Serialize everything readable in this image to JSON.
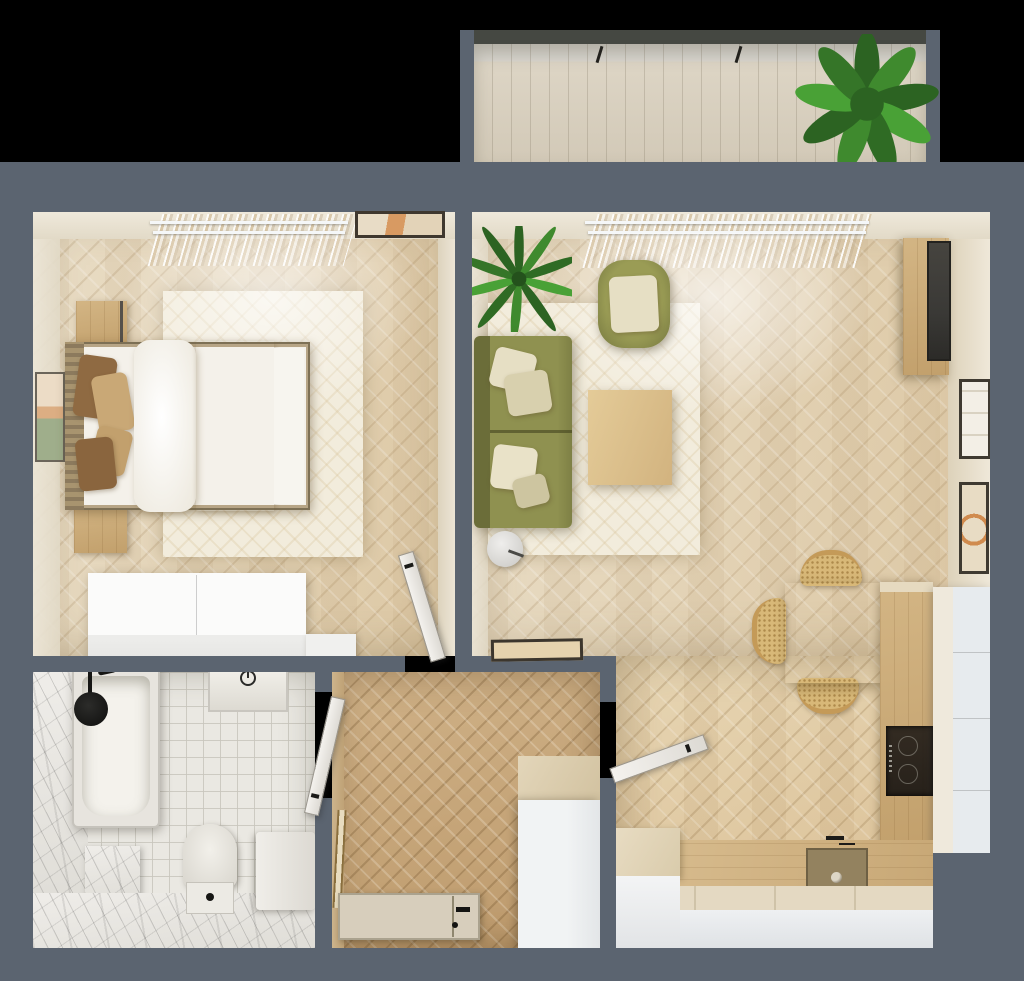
{
  "meta": {
    "title": "apartment-floor-plan-top-view",
    "type": "photorealistic 3D top-down render of a one-bedroom apartment",
    "visible_text": "none"
  },
  "palette": {
    "background": "#000000",
    "wall": "#5b6470",
    "balcony_top_wall": "#454842",
    "deck": "#ddd5c5",
    "floor_light": "#e9ddc6",
    "floor_mid": "#dcc7a3",
    "floor_hall": "#cfb187",
    "rug": "#f2ecdc",
    "tile": "#eae8e2",
    "marble": "#efede9",
    "wood": "#d6ba8c",
    "wood_table": "#eedfb2",
    "cane": "#d8b878",
    "sofa": "#8f9150",
    "sofa_shadow": "#6b6d39",
    "cushion": "#e6dfc4",
    "pillow_tan": "#c9a876",
    "pillow_brown": "#8f6a42",
    "duvet": "#f8f6f1",
    "throw": "#cdab7c",
    "white_furniture": "#f2f3f4",
    "cabinet_front": "#e7ebee",
    "tv": "#3a3936",
    "hob": "#27211a",
    "sink": "#93825f",
    "entry_door": "#d7cebc",
    "plant_green": "#3f8a2e",
    "plant_dark": "#2c6322"
  },
  "rooms": [
    {
      "name": "balcony",
      "furniture": [
        "potted-plant",
        "plank-decking"
      ]
    },
    {
      "name": "bedroom",
      "furniture": [
        "double-bed",
        "pillows",
        "duvet",
        "throw-blanket",
        "nightstand-top",
        "nightstand-bottom",
        "area-rug",
        "white-wardrobe",
        "wall-art-top",
        "wall-art-left",
        "sheer-curtains",
        "open-door"
      ]
    },
    {
      "name": "living-room",
      "furniture": [
        "olive-sofa",
        "olive-armchair",
        "coffee-table",
        "floor-lamp",
        "area-rug",
        "palm-plant",
        "media-console",
        "tv-panel",
        "wall-art-small",
        "wall-art-arc",
        "leaning-art",
        "sheer-curtains"
      ]
    },
    {
      "name": "dining-area",
      "furniture": [
        "square-wood-table",
        "cane-chair-top",
        "cane-chair-left",
        "cane-chair-bottom"
      ]
    },
    {
      "name": "kitchen",
      "furniture": [
        "wood-counter-right",
        "induction-hob",
        "tall-white-cabinet",
        "bottom-counter",
        "sink-basin",
        "faucet",
        "white-base-cabinets",
        "left-cabinet"
      ]
    },
    {
      "name": "hallway",
      "furniture": [
        "white-wardrobe",
        "entrance-door",
        "leaning-mirror",
        "open-door-bathroom",
        "open-door-living"
      ]
    },
    {
      "name": "bathroom",
      "furniture": [
        "bathtub",
        "rain-shower-head",
        "wall-hung-basin",
        "toilet",
        "washing-machine",
        "marble-bench"
      ]
    }
  ]
}
